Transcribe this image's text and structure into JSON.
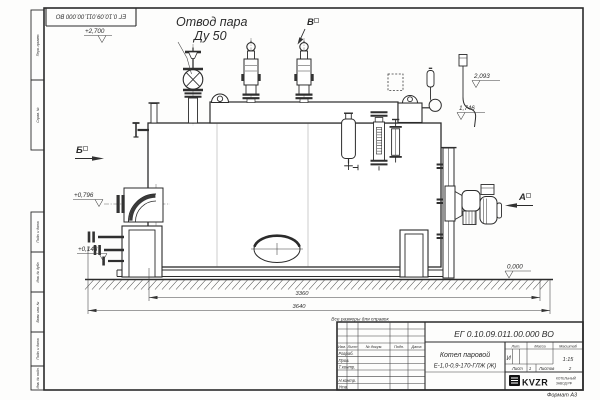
{
  "sheet": {
    "doc_number_top": "ЕГ 0.10.09.011.00.000  ВО",
    "format_label": "Формат А3"
  },
  "frame_stamps": {
    "s1": "Перв. примен.",
    "s2": "Справ. №",
    "s3": "Подп. и дата",
    "s4": "Инв. № дубл.",
    "s5": "Взам. инв. №",
    "s6": "Подп. и дата",
    "s7": "Инв. № подл."
  },
  "callouts": {
    "steam_outlet_line1": "Отвод пара",
    "steam_outlet_line2": "Ду 50",
    "reference_note": "Все размеры для справок"
  },
  "views": {
    "a": "А",
    "b": "Б",
    "v": "В"
  },
  "elevations": {
    "top": "+2,700",
    "right_upper": "2,093",
    "right_lower": "1,746",
    "left_upper": "+0,796",
    "left_lower": "+0,143",
    "zero": "0,000"
  },
  "dimensions": {
    "inner_length": "3360",
    "overall_length": "3640"
  },
  "title_block": {
    "doc_number": "ЕГ 0.10.09.011.00.000  ВО",
    "product_name": "Котел паровой",
    "product_type": "Е-1,0-0,9-170-ГЛЖ (Ж)",
    "col_izm": "Изм.",
    "col_list": "Лист",
    "col_docum": "№ докум.",
    "col_podp": "Подп.",
    "col_data": "Дата",
    "row_razrab": "Разраб.",
    "row_prov": "Пров.",
    "row_tkontr": "Т.контр.",
    "row_nkontr": "Н.контр.",
    "row_utv": "Утв.",
    "lit_header": "Лит.",
    "lit_value": "И",
    "mass_header": "Масса",
    "scale_header": "Масштаб",
    "scale_value": "1:15",
    "sheet_label": "Лист",
    "sheet_value": "1",
    "sheets_label": "Листов",
    "sheets_value": "2",
    "logo_text": "KVZR",
    "logo_caption1": "КОТЕЛЬНЫЙ",
    "logo_caption2": "ЗАВОД РФ"
  },
  "colors": {
    "ink": "#2b2b2b",
    "paper": "#ffffff",
    "logo_black": "#111111"
  }
}
